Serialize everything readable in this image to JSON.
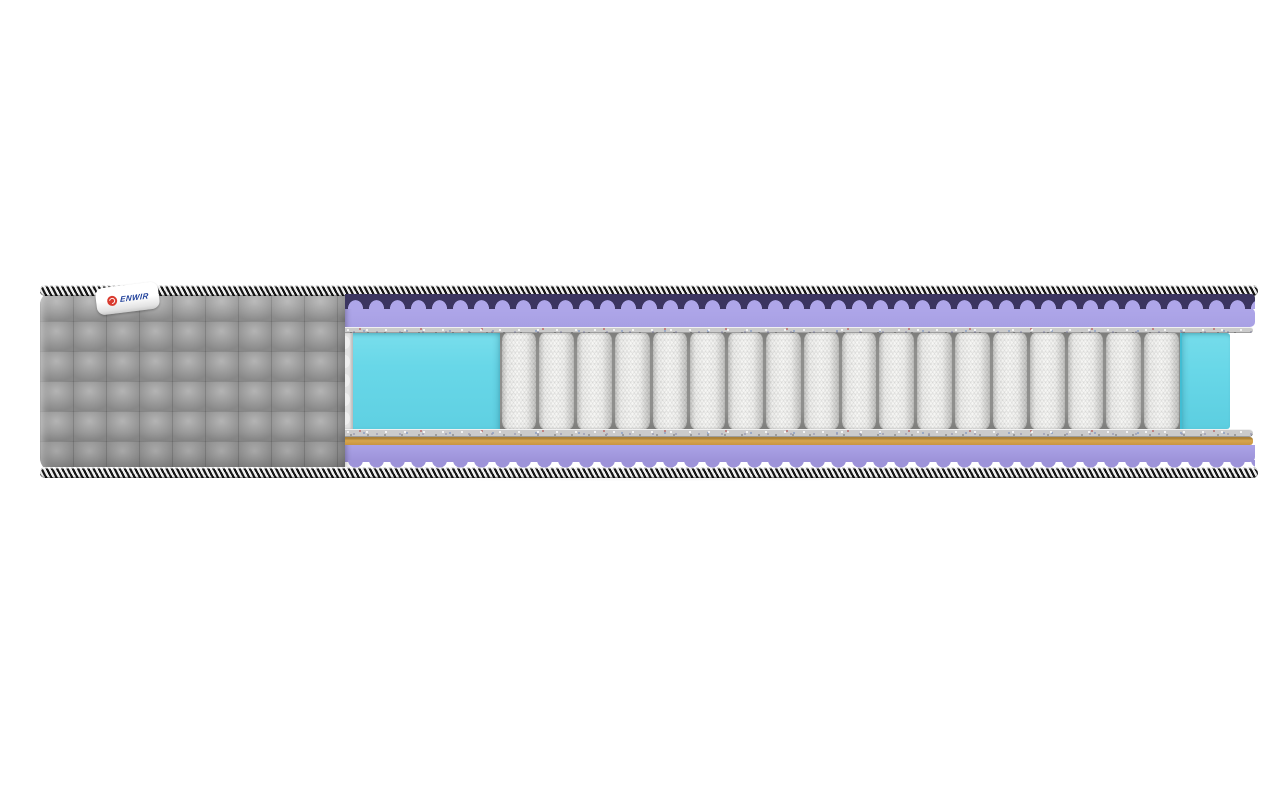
{
  "meta": {
    "type": "product-render",
    "subject": "mattress cross-section cutaway",
    "background_color": "#ffffff"
  },
  "brand_label": {
    "text": "ENWIR",
    "logo_color": "#d93a2e",
    "text_color": "#20409a",
    "bg_color": "#ffffff"
  },
  "mattress": {
    "spring_count": 18,
    "colors": {
      "quilt_gray": "#9d9d9d",
      "quilt_highlight": "#b4b4b4",
      "quilt_shadow": "#888888",
      "tape_dark": "#161616",
      "tape_light": "#efefef",
      "foam_purple": "#a8a0e4",
      "foam_purple_light": "#aea6e9",
      "foam_purple_deep": "#3b3560",
      "felt_gray": "#cbcbcb",
      "foam_cyan": "#68d7e8",
      "foam_cyan_edge": "#41bdd3",
      "coir_orange": "#d7a54d",
      "coir_orange_edge": "#aa8138",
      "spring_white": "#f7f7f5",
      "spring_shade": "#c6c6c4",
      "spring_gap": "#8f8f8d"
    }
  }
}
